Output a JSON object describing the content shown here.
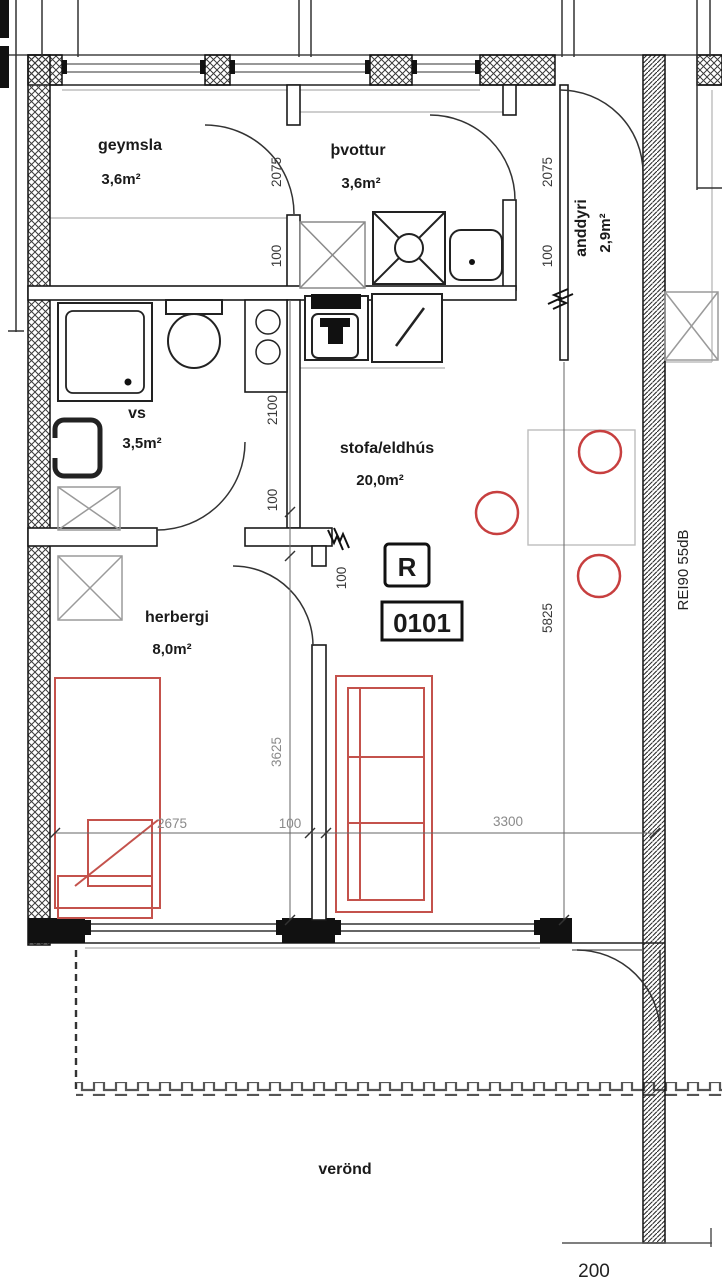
{
  "drawing": {
    "type": "apartment floor plan",
    "unit_marker": {
      "letter": "R",
      "number": "0101"
    },
    "fire_sound_rating": "REI90 55dB",
    "rooms": {
      "geymsla": {
        "name": "geymsla",
        "area": "3,6m²"
      },
      "thvottur": {
        "name": "þvottur",
        "area": "3,6m²"
      },
      "anddyri": {
        "name": "anddyri",
        "area": "2,9m²"
      },
      "vs": {
        "name": "vs",
        "area": "3,5m²"
      },
      "stofa_eldhus": {
        "name": "stofa/eldhús",
        "area": "20,0m²"
      },
      "herbergi": {
        "name": "herbergi",
        "area": "8,0m²"
      },
      "verond": {
        "name": "verönd"
      }
    },
    "dimensions": {
      "left_top_v": "2075",
      "left_top_wall": "100",
      "vs_v": "2100",
      "vs_wall": "100",
      "stub_wall": "100",
      "herbergi_v": "3625",
      "right_top_v": "2075",
      "right_top_wall": "100",
      "stofa_v": "5825",
      "herbergi_h": "2675",
      "mid_wall_h": "100",
      "stofa_h": "3300",
      "veranda_edge": "200"
    },
    "colors": {
      "furniture_red": "#c4524c",
      "chair_red": "#c73f3f",
      "line_black": "#222222",
      "dim_gray": "#8a8a8a"
    }
  }
}
